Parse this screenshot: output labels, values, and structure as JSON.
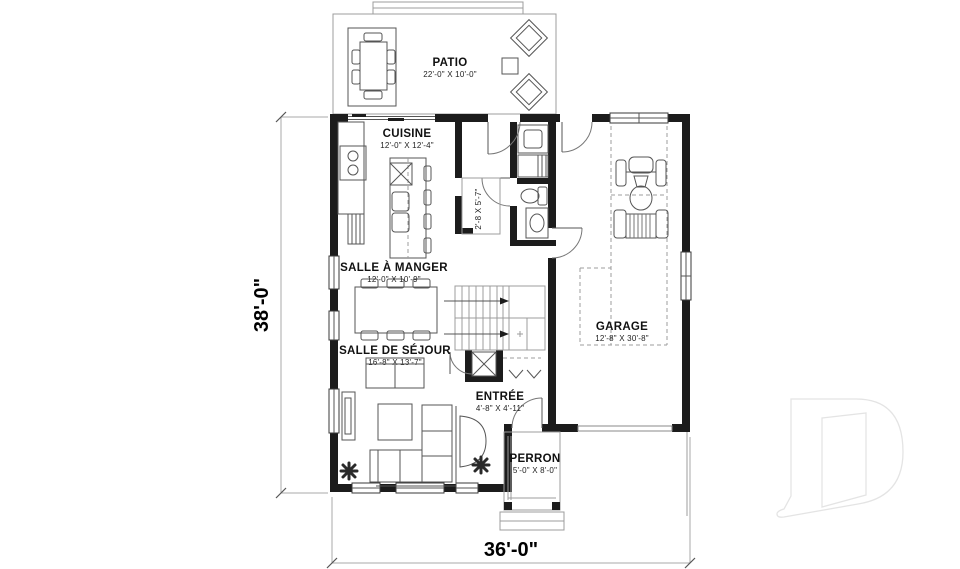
{
  "plan": {
    "patio": {
      "label": "PATIO",
      "size": "22'-0\" X 10'-0\""
    },
    "cuisine": {
      "label": "CUISINE",
      "size": "12'-0\" X 12'-4\""
    },
    "garde_manger": {
      "size": "2'-8 X 5'-7\""
    },
    "salle_a_manger": {
      "label": "SALLE À MANGER",
      "size": "12'-0\" X 10'-9\""
    },
    "salle_de_sejour": {
      "label": "SALLE DE SÉJOUR",
      "size": "16'-8\" X 13'-7\""
    },
    "entree": {
      "label": "ENTRÉE",
      "size": "4'-8\" X 4'-11\""
    },
    "perron": {
      "label": "PERRON",
      "size": "5'-0\" X 8'-0\""
    },
    "garage": {
      "label": "GARAGE",
      "size": "12'-8\" X 30'-8\""
    },
    "overall": {
      "depth": "38'-0\"",
      "width": "36'-0\""
    },
    "watermark_monogram": "D",
    "colors": {
      "wall": "#1c1c1c",
      "furniture_line": "#555555",
      "outline": "#9c9c9c",
      "logo": "#e4e4e4"
    }
  }
}
